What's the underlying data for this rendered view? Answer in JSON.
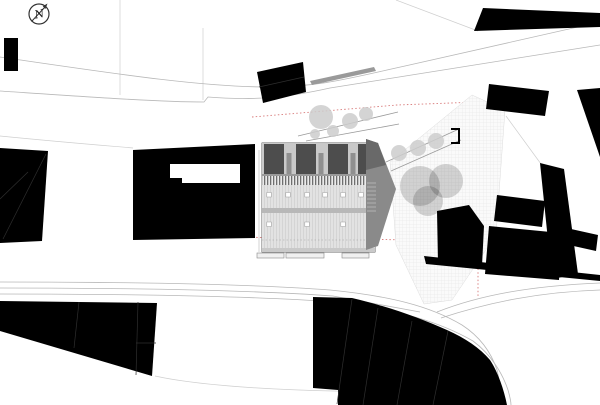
{
  "plan": {
    "type": "architectural-site-plan",
    "north_label": "N",
    "colors": {
      "footprint_black": "#000000",
      "boundary_red": "#d87a7a",
      "road_line_gray": "#b8b8b8",
      "parcel_line_gray": "#cfcfcf",
      "roof_light_gray": "#e2e2e2",
      "roof_block_dark": "#4d4d4d",
      "rib_gray": "#6f6f6f",
      "shadow_wedge_gray": "#8a8a8a",
      "tree_canopy_gray": "rgba(0,0,0,0.16)",
      "small_tree_gray": "#cdcdcd",
      "plaza_grid_gray": "#e4e4e4"
    },
    "elements": {
      "north_arrow": "compass circle with NE arrow",
      "main_building": "central project building with striped roof, dormer blocks, skylights and cast shadow",
      "context_buildings": "solid black figure-ground footprints",
      "plaza": "gridded paved courtyard with three large tree canopies",
      "roads": "upper sweeping street, lower street with fork",
      "boundary": "red dashed property line"
    }
  }
}
